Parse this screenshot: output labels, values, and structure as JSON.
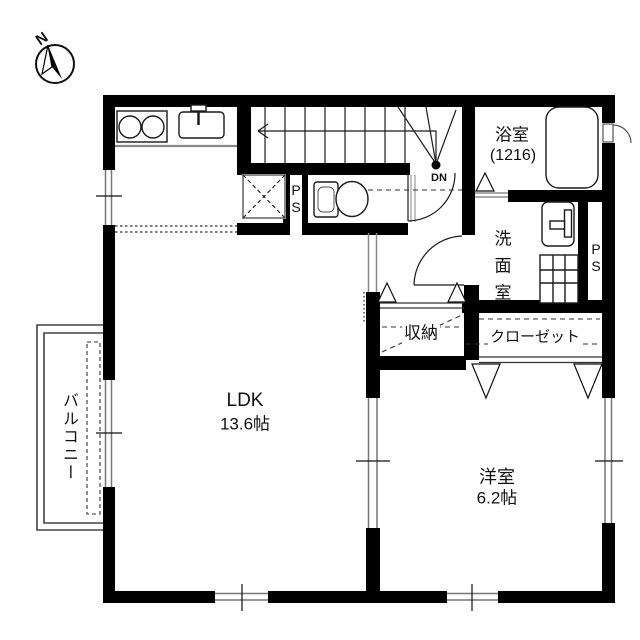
{
  "compass": {
    "north_label": "N"
  },
  "stairs": {
    "down_label": "DN"
  },
  "rooms": {
    "ldk": {
      "name": "LDK",
      "area": "13.6帖"
    },
    "western_room": {
      "name": "洋室",
      "area": "6.2帖"
    },
    "bathroom": {
      "name": "浴室",
      "size": "(1216)"
    },
    "washroom": {
      "name": "洗面室"
    },
    "storage": {
      "name": "収納"
    },
    "closet": {
      "name": "クローゼット"
    },
    "balcony": {
      "name": "バルコニー"
    },
    "pipe_space_hall": {
      "label": "PS"
    },
    "pipe_space_washroom": {
      "label": "PS"
    }
  },
  "colors": {
    "wall": "#000000",
    "line_dark": "#1a1a1a",
    "line_gray": "#808080",
    "background": "#ffffff"
  }
}
